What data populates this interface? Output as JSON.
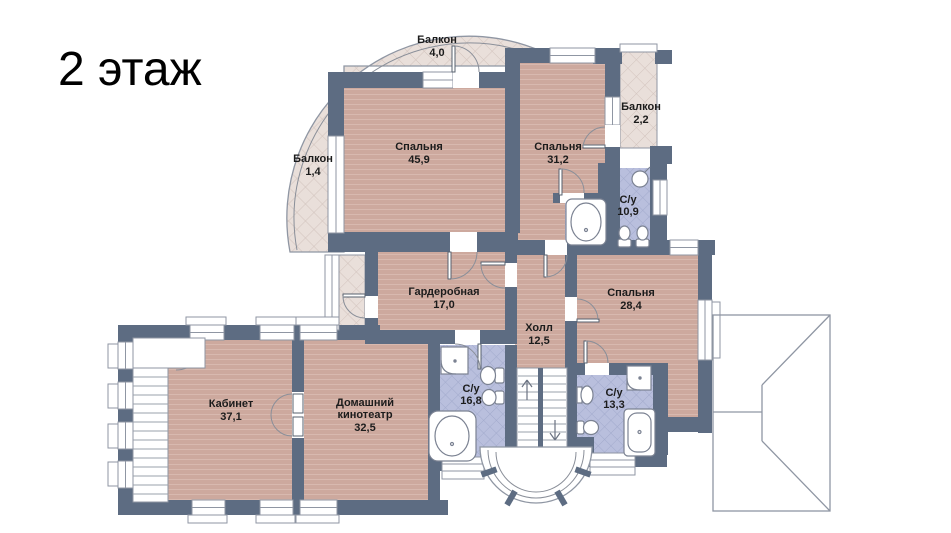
{
  "title": "2 этаж",
  "rooms": {
    "balcony_top": {
      "name": "Балкон",
      "area": "4,0"
    },
    "balcony_left": {
      "name": "Балкон",
      "area": "1,4"
    },
    "balcony_right": {
      "name": "Балкон",
      "area": "2,2"
    },
    "bedroom_large": {
      "name": "Спальня",
      "area": "45,9"
    },
    "bedroom_mid": {
      "name": "Спальня",
      "area": "31,2"
    },
    "bathroom_top": {
      "name": "С/у",
      "area": "10,9"
    },
    "wardrobe": {
      "name": "Гардеробная",
      "area": "17,0"
    },
    "hall": {
      "name": "Холл",
      "area": "12,5"
    },
    "bedroom_right": {
      "name": "Спальня",
      "area": "28,4"
    },
    "office": {
      "name": "Кабинет",
      "area": "37,1"
    },
    "home_theater": {
      "name_line1": "Домашний",
      "name_line2": "кинотеатр",
      "area": "32,5"
    },
    "bathroom_center": {
      "name": "С/у",
      "area": "16,8"
    },
    "bathroom_bottom": {
      "name": "С/у",
      "area": "13,3"
    }
  },
  "colors": {
    "wall": "#5d6c82",
    "floor": "#cda99e",
    "floorLine": "#d8b9af",
    "bath": "#b9bfdd",
    "bathLine": "#a2aacc",
    "balc": "#e9dfda",
    "balcLine": "#d2c3bd",
    "line": "#8f96a3",
    "ink": "#1c1c1c"
  }
}
